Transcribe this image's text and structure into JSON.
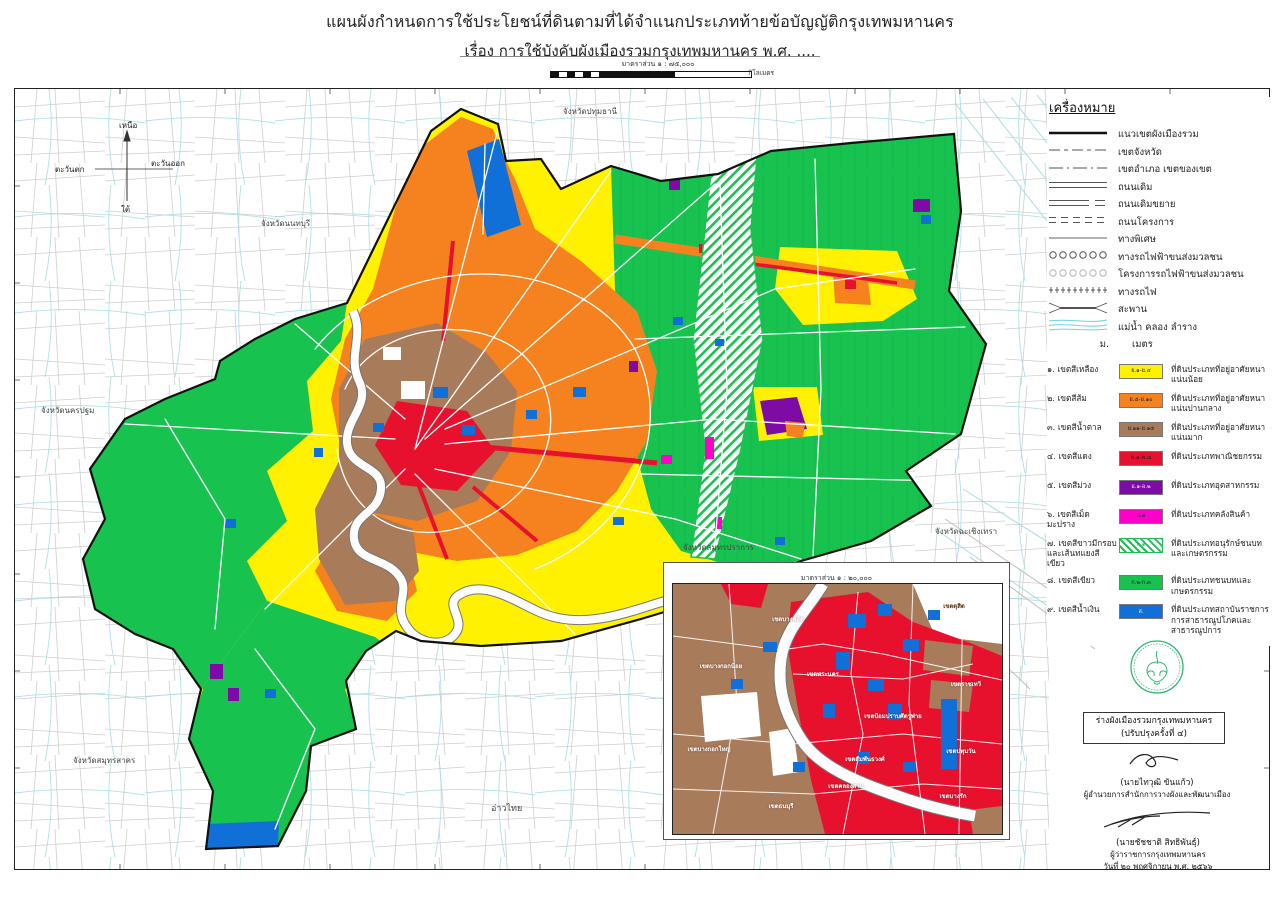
{
  "title": {
    "line1": "แผนผังกำหนดการใช้ประโยชน์ที่ดินตามที่ได้จำแนกประเภทท้ายข้อบัญญัติกรุงเทพมหานคร",
    "line2": "เรื่อง การใช้บังคับผังเมืองรวมกรุงเทพมหานคร พ.ศ. ...."
  },
  "main_scale": {
    "label": "มาตราส่วน ๑ : ๗๕,๐๐๐",
    "unit": "กิโลเมตร"
  },
  "compass": {
    "north": "เหนือ",
    "south": "ใต้",
    "east": "ตะวันออก",
    "west": "ตะวันตก"
  },
  "map_labels": {
    "pathum_thani": "จังหวัดปทุมธานี",
    "nonthaburi": "จังหวัดนนทบุรี",
    "nakhon_pathom": "จังหวัดนครปฐม",
    "samut_sakhon": "จังหวัดสมุทรสาคร",
    "chachoengsao": "จังหวัดฉะเชิงเทรา",
    "samut_prakan": "จังหวัดสมุทรปราการ",
    "gulf": "อ่าวไทย"
  },
  "legend": {
    "title": "เครื่องหมาย",
    "line_items": [
      {
        "symbol": "plan-boundary-line",
        "label": "แนวเขตผังเมืองรวม"
      },
      {
        "symbol": "province-boundary-line",
        "label": "เขตจังหวัด"
      },
      {
        "symbol": "district-boundary-line",
        "label": "เขตอำเภอ เขตของเขต"
      },
      {
        "symbol": "existing-road",
        "label": "ถนนเดิม"
      },
      {
        "symbol": "existing-road-widened",
        "label": "ถนนเดิมขยาย"
      },
      {
        "symbol": "planned-road",
        "label": "ถนนโครงการ"
      },
      {
        "symbol": "expressway",
        "label": "ทางพิเศษ"
      },
      {
        "symbol": "mass-transit-line",
        "label": "ทางรถไฟฟ้าขนส่งมวลชน"
      },
      {
        "symbol": "mass-transit-project",
        "label": "โครงการรถไฟฟ้าขนส่งมวลชน"
      },
      {
        "symbol": "railway",
        "label": "ทางรถไฟ"
      },
      {
        "symbol": "bridge",
        "label": "สะพาน"
      },
      {
        "symbol": "waterway",
        "label": "แม่น้ำ คลอง ลำราง"
      },
      {
        "symbol": "meter-abbrev",
        "abbrev": "ม.",
        "label": "เมตร"
      }
    ],
    "zone_items": [
      {
        "no": "๑.",
        "name": "เขตสีเหลือง",
        "code": "ย.๑-ย.๔",
        "color": "#FFF100",
        "desc": "ที่ดินประเภทที่อยู่อาศัยหนาแน่นน้อย"
      },
      {
        "no": "๒.",
        "name": "เขตสีส้ม",
        "code": "ย.๕-ย.๑๐",
        "color": "#F5821F",
        "desc": "ที่ดินประเภทที่อยู่อาศัยหนาแน่นปานกลาง"
      },
      {
        "no": "๓.",
        "name": "เขตสีน้ำตาล",
        "code": "ย.๑๑-ย.๑๕",
        "color": "#A87B5B",
        "desc": "ที่ดินประเภทที่อยู่อาศัยหนาแน่นมาก"
      },
      {
        "no": "๔.",
        "name": "เขตสีแดง",
        "code": "พ.๑-พ.๘",
        "color": "#E8112D",
        "desc": "ที่ดินประเภทพาณิชยกรรม"
      },
      {
        "no": "๕.",
        "name": "เขตสีม่วง",
        "code": "อ.๑-อ.๒",
        "color": "#7E0BA5",
        "desc": "ที่ดินประเภทอุตสาหกรรม"
      },
      {
        "no": "๖.",
        "name": "เขตสีเม็ดมะปราง",
        "code": "อ.๓",
        "color": "#FF00C8",
        "desc": "ที่ดินประเภทคลังสินค้า"
      },
      {
        "no": "๗.",
        "name": "เขตสีขาวมีกรอบ",
        "name2": "และเส้นทแยงสีเขียว",
        "code": "ก.๑",
        "color": "green-hatch",
        "desc": "ที่ดินประเภทอนุรักษ์ชนบทและเกษตรกรรม"
      },
      {
        "no": "๘.",
        "name": "เขตสีเขียว",
        "code": "ก.๒-ก.๓",
        "color": "#17C24F",
        "desc": "ที่ดินประเภทชนบทและเกษตรกรรม"
      },
      {
        "no": "๙.",
        "name": "เขตสีน้ำเงิน",
        "code": "ส.",
        "color": "#1070D8",
        "desc": "ที่ดินประเภทสถาบันราชการ",
        "desc2": "การสาธารณูปโภคและสาธารณูปการ"
      }
    ]
  },
  "inset": {
    "scale_label": "มาตราส่วน ๑ : ๒๐,๐๐๐",
    "unit": "กิโลเมตร",
    "districts": [
      {
        "label": "เขตบางพลัด"
      },
      {
        "label": "เขตดุสิต"
      },
      {
        "label": "เขตบางกอกน้อย"
      },
      {
        "label": "เขตพระนคร"
      },
      {
        "label": "เขตป้อมปราบศัตรูพ่าย"
      },
      {
        "label": "เขตราชเทวี"
      },
      {
        "label": "เขตปทุมวัน"
      },
      {
        "label": "เขตบางกอกใหญ่"
      },
      {
        "label": "เขตสัมพันธวงศ์"
      },
      {
        "label": "เขตคลองสาน"
      },
      {
        "label": "เขตธนบุรี"
      },
      {
        "label": "เขตบางรัก"
      }
    ]
  },
  "plan_box": {
    "line1": "ร่างผังเมืองรวมกรุงเทพมหานคร",
    "line2": "(ปรับปรุงครั้งที่ ๔)"
  },
  "signatures": [
    {
      "name": "(นายไทวุฒิ ขันแก้ว)",
      "role": "ผู้อำนวยการสำนักการวางผังและพัฒนาเมือง"
    },
    {
      "name": "(นายชัชชาติ สิทธิพันธุ์)",
      "role": "ผู้ว่าราชการกรุงเทพมหานคร",
      "date": "วันที่ ๒๐ พฤศจิกายน พ.ศ. ๒๕๖๖"
    }
  ],
  "colors": {
    "seal_green": "#2EB872",
    "water": "#a5dde2",
    "outside_roads": "#c2c2c2",
    "boundary": "#111111"
  }
}
